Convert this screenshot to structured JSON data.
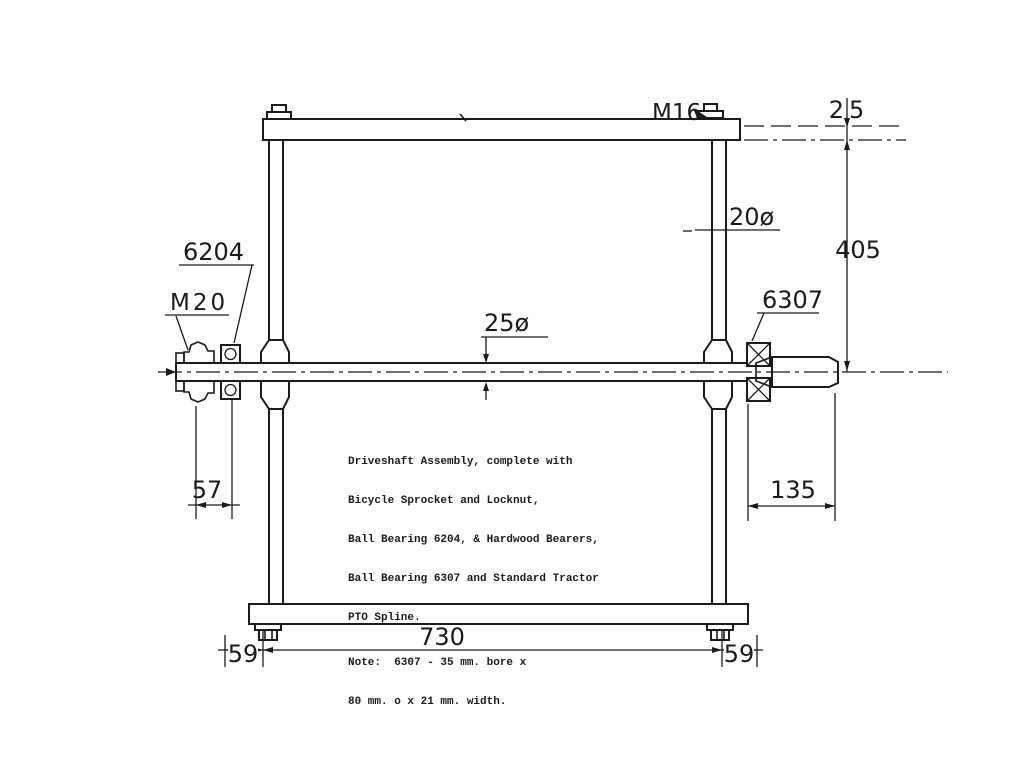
{
  "drawing": {
    "title_labels": {
      "m16": "M16",
      "dim25_top": "25",
      "dia20": "20ø",
      "dim405": "405",
      "bearing_left": "6204",
      "m20": "M20",
      "dia25": "25ø",
      "bearing_right": "6307",
      "dim57": "57",
      "dim135": "135",
      "dim730": "730",
      "dim59_left": "59",
      "dim59_right": "59"
    },
    "description": {
      "line1": "Driveshaft Assembly, complete with",
      "line2": "Bicycle Sprocket and Locknut,",
      "line3": "Ball Bearing 6204, & Hardwood Bearers,",
      "line4": "Ball Bearing 6307 and Standard Tractor",
      "line5": "PTO Spline.",
      "note_line1": "Note:  6307 - 35 mm. bore x",
      "note_line2": "80 mm. o x 21 mm. width."
    },
    "colors": {
      "ink": "#1b1b1b",
      "paper": "#ffffff"
    }
  }
}
